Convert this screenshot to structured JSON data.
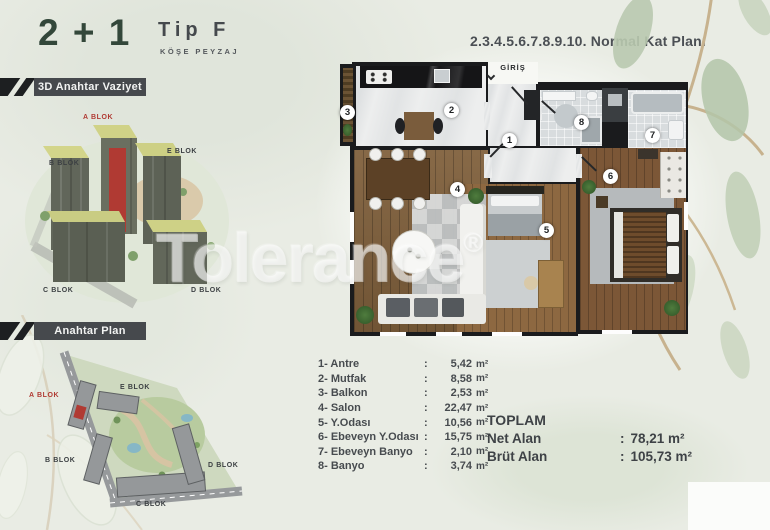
{
  "header": {
    "unit_type": "2 + 1",
    "type_code": "Tip F",
    "type_subtitle": "KÖŞE PEYZAJ",
    "plan_title": "2.3.4.5.6.7.8.9.10. Normal Kat Planı"
  },
  "section_labels": {
    "render3d": "3D Anahtar Vaziyet",
    "siteplan": "Anahtar Plan"
  },
  "blocks": {
    "a": "A BLOK",
    "b": "B BLOK",
    "c": "C BLOK",
    "d": "D BLOK",
    "e": "E BLOK"
  },
  "floorplan": {
    "entrance": "GİRİŞ",
    "numbers": {
      "n1": "1",
      "n2": "2",
      "n3": "3",
      "n4": "4",
      "n5": "5",
      "n6": "6",
      "n7": "7",
      "n8": "8"
    }
  },
  "room_list": {
    "colon": ":",
    "unit": "m²",
    "rows": [
      {
        "name": "1- Antre",
        "value": "5,42"
      },
      {
        "name": "2- Mutfak",
        "value": "8,58"
      },
      {
        "name": "3- Balkon",
        "value": "2,53"
      },
      {
        "name": "4- Salon",
        "value": "22,47"
      },
      {
        "name": "5- Y.Odası",
        "value": "10,56"
      },
      {
        "name": "6- Ebeveyn Y.Odası",
        "value": "15,75"
      },
      {
        "name": "7- Ebeveyn Banyo",
        "value": "2,10"
      },
      {
        "name": "8- Banyo",
        "value": "3,74"
      }
    ]
  },
  "totals": {
    "title": "TOPLAM",
    "colon": ":",
    "rows": [
      {
        "label": "Net Alan",
        "value": "78,21 m²"
      },
      {
        "label": "Brüt Alan",
        "value": "105,73 m²"
      }
    ]
  },
  "watermark": {
    "text": "Tolerance",
    "reg": "®"
  },
  "colors": {
    "accent_red": "#b03a33",
    "dark_green": "#33473a",
    "badge_bar": "#46494d",
    "text_dark": "#45494d",
    "background": "#e9ece4"
  }
}
